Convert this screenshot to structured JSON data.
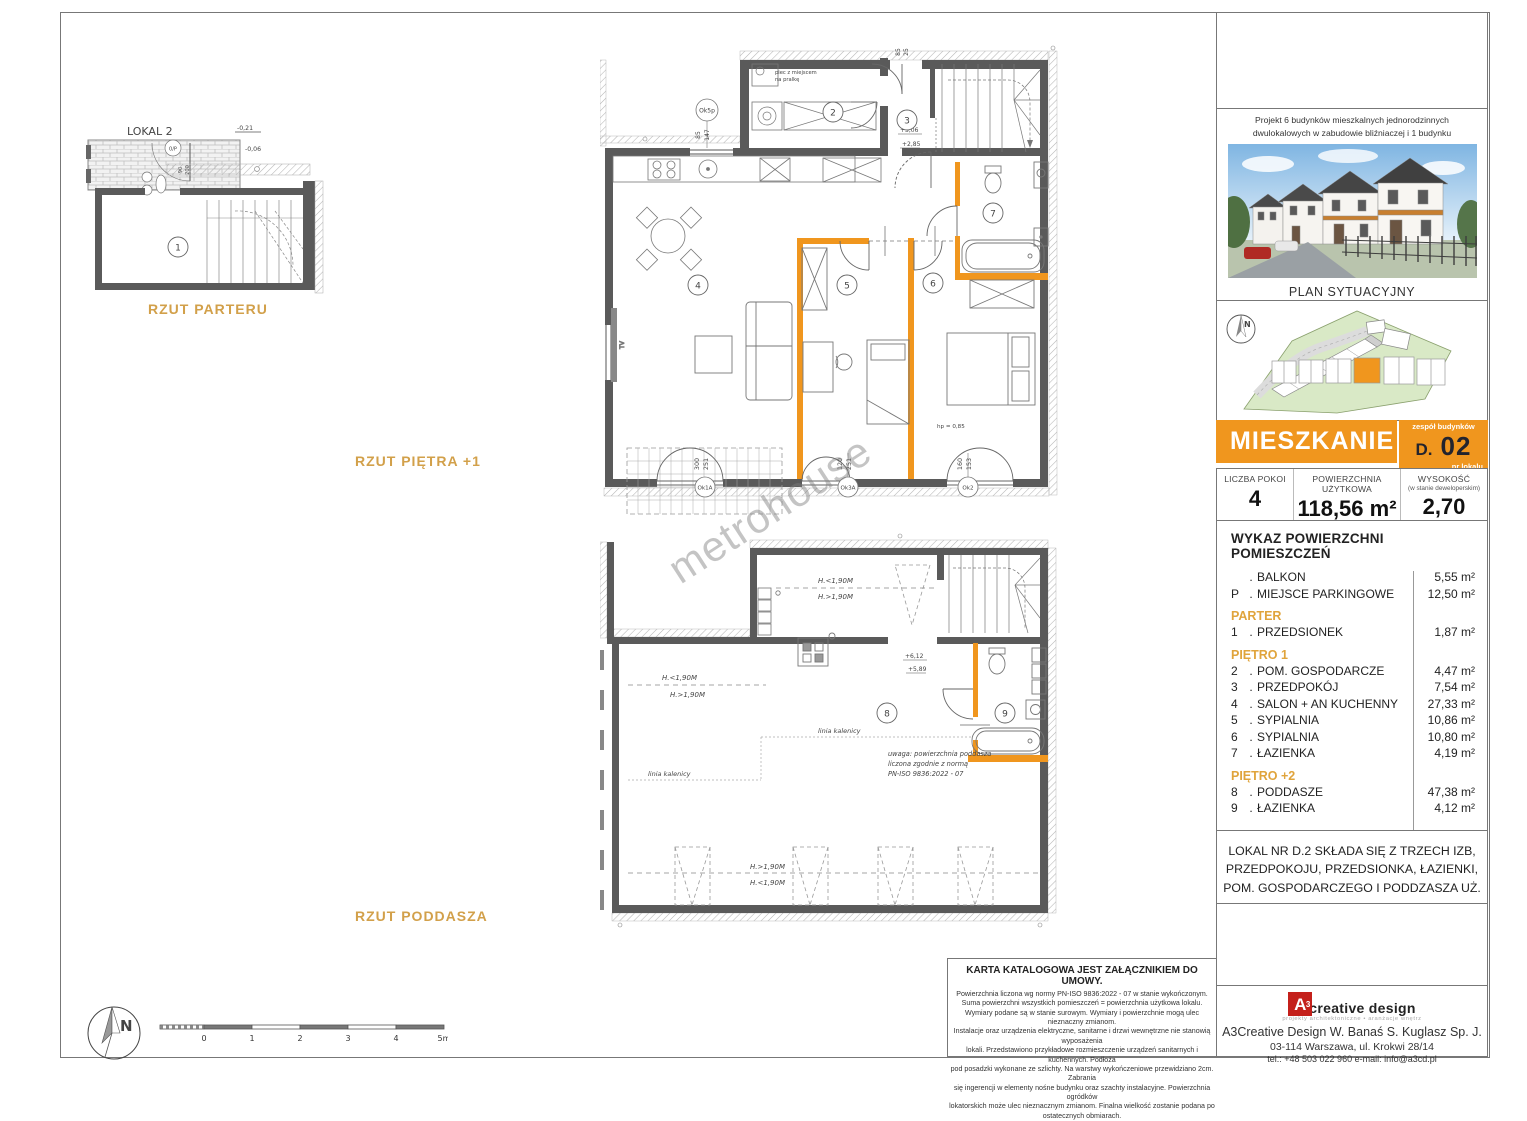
{
  "watermark": "metrohouse",
  "plan_labels": {
    "parter": "RZUT PARTERU",
    "pietro": "RZUT PIĘTRA +1",
    "poddasze": "RZUT PODDASZA"
  },
  "parter_plan": {
    "lokal2": "LOKAL 2",
    "level_a": "-0,21",
    "level_b": "-0,06",
    "door_code": "0/P",
    "door_dim_a": "90",
    "door_dim_b": "200",
    "room1": "1"
  },
  "pietro_plan": {
    "rooms": {
      "r2": "2",
      "r3": "3",
      "r4": "4",
      "r5": "5",
      "r6": "6",
      "r7": "7"
    },
    "window_codes": {
      "top": "Ok5p",
      "w1": "Ok1A",
      "w2": "Ok3A",
      "w3": "Ok2"
    },
    "dims": {
      "top_a": "85",
      "top_b": "25",
      "side_a": "85",
      "side_b": "147",
      "w1a": "300",
      "w1b": "251",
      "w2a": "120",
      "w2b": "251",
      "w3a": "160",
      "w3b": "153"
    },
    "levels": {
      "a": "+3,06",
      "b": "+2,85"
    },
    "boiler_note_1": "piec z miejscem",
    "boiler_note_2": "na pralkę",
    "tv": "TV",
    "hp": "hp = 0,85"
  },
  "poddasze_plan": {
    "rooms": {
      "r8": "8",
      "r9": "9"
    },
    "h_less": "H.<1,90M",
    "h_more": "H.>1,90M",
    "ridge": "linia kalenicy",
    "levels": {
      "a": "+6,12",
      "b": "+5,89"
    },
    "note1": "uwaga: powierzchnia poddasza",
    "note2": "liczona zgodnie z normą",
    "note3": "PN-ISO 9836:2022 - 07"
  },
  "compass": {
    "label": "N"
  },
  "scale_bar": {
    "ticks": [
      "0",
      "1",
      "2",
      "3",
      "4",
      "5m"
    ]
  },
  "sidebar": {
    "project_description": "Projekt 6 budynków mieszkalnych jednorodzinnych dwulokalowych w zabudowie bliźniaczej i 1 budynku mieszkalnego jednorodzinnego dwulokalowego wolno stojącego na dz. ew. Nr 7/26 i 121 z obr. 0005 przy ul. Witosa w Radzyminie,",
    "site_plan_label": "PLAN SYTUACYJNY",
    "site_compass": "N",
    "header": {
      "title": "MIESZKANIE",
      "group_label": "zespół budynków",
      "building": "D.",
      "unit": "02",
      "unit_label": "nr lokalu"
    },
    "stats": {
      "s1_label": "LICZBA POKOI",
      "s1_value": "4",
      "s2_label": "POWIERZCHNIA UŻYTKOWA",
      "s2_value": "118,56 m²",
      "s3_label": "WYSOKOŚĆ",
      "s3_sub": "(w stanie deweloperskim)",
      "s3_value": "2,70"
    },
    "rooms": {
      "title": "WYKAZ POWIERZCHNI POMIESZCZEŃ",
      "pre": [
        {
          "no": "",
          "name": "BALKON",
          "area": "5,55 m²"
        },
        {
          "no": "P",
          "name": "MIEJSCE PARKINGOWE",
          "area": "12,50 m²"
        }
      ],
      "groups": [
        {
          "heading": "PARTER"
        },
        {
          "heading": "PIĘTRO 1"
        },
        {
          "heading": "PIĘTRO +2"
        }
      ],
      "g1": [
        {
          "no": "1",
          "name": "PRZEDSIONEK",
          "area": "1,87 m²"
        }
      ],
      "g2": [
        {
          "no": "2",
          "name": "POM. GOSPODARCZE",
          "area": "4,47 m²"
        },
        {
          "no": "3",
          "name": "PRZEDPOKÓJ",
          "area": "7,54 m²"
        },
        {
          "no": "4",
          "name": "SALON + AN KUCHENNY",
          "area": "27,33 m²"
        },
        {
          "no": "5",
          "name": "SYPIALNIA",
          "area": "10,86 m²"
        },
        {
          "no": "6",
          "name": "SYPIALNIA",
          "area": "10,80 m²"
        },
        {
          "no": "7",
          "name": "ŁAZIENKA",
          "area": "4,19 m²"
        }
      ],
      "g3": [
        {
          "no": "8",
          "name": "PODDASZE",
          "area": "47,38 m²"
        },
        {
          "no": "9",
          "name": "ŁAZIENKA",
          "area": "4,12 m²"
        }
      ]
    },
    "lokal_note_1": "LOKAL NR D.2 SKŁADA SIĘ Z TRZECH IZB,",
    "lokal_note_2": "PRZEDPOKOJU, PRZEDSIONKA, ŁAZIENKI,",
    "lokal_note_3": "POM. GOSPODARCZEGO I PODDZASZA UŻ.",
    "footer": {
      "logo_letter": "A",
      "logo_sup": "3",
      "logo_name": "creative design",
      "logo_tag": "projekty architektoniczne • aranżacje wnętrz",
      "company": "A3Creative Design W. Banaś S. Kuglasz Sp. J.",
      "address": "03-114 Warszawa, ul. Krokwi 28/14",
      "contact": "tel.: +48 503 022 960   e-mail: info@a3cd.pl"
    }
  },
  "disclaimer": {
    "title": "KARTA KATALOGOWA JEST ZAŁĄCZNIKIEM DO UMOWY.",
    "lines": [
      "Powierzchnia liczona wg normy PN-ISO 9836:2022 - 07 w stanie wykończonym.",
      "Suma powierzchni wszystkich pomieszczeń = powierzchnia użytkowa lokalu.",
      "Wymiary podane są w stanie surowym. Wymiary i powierzchnie mogą ulec nieznaczny zmianom.",
      "Instalacje oraz urządzenia elektryczne, sanitarne i drzwi wewnętrzne nie stanowią wyposażenia",
      "lokali. Przedstawiono przykładowe rozmieszczenie urządzeń sanitarnych i kuchennych. Podłoża",
      "pod posadzki wykonane ze szlichty. Na warstwy wykończeniowe przewidziano 2cm.  Zabrania",
      "się ingerencji w elementy nośne budynku oraz szachty instalacyjne. Powierzchnia ogródków",
      "lokatorskich może ulec nieznacznym zmianom. Finalna wielkość zostanie podana po",
      "ostatecznych obmiarach."
    ]
  }
}
